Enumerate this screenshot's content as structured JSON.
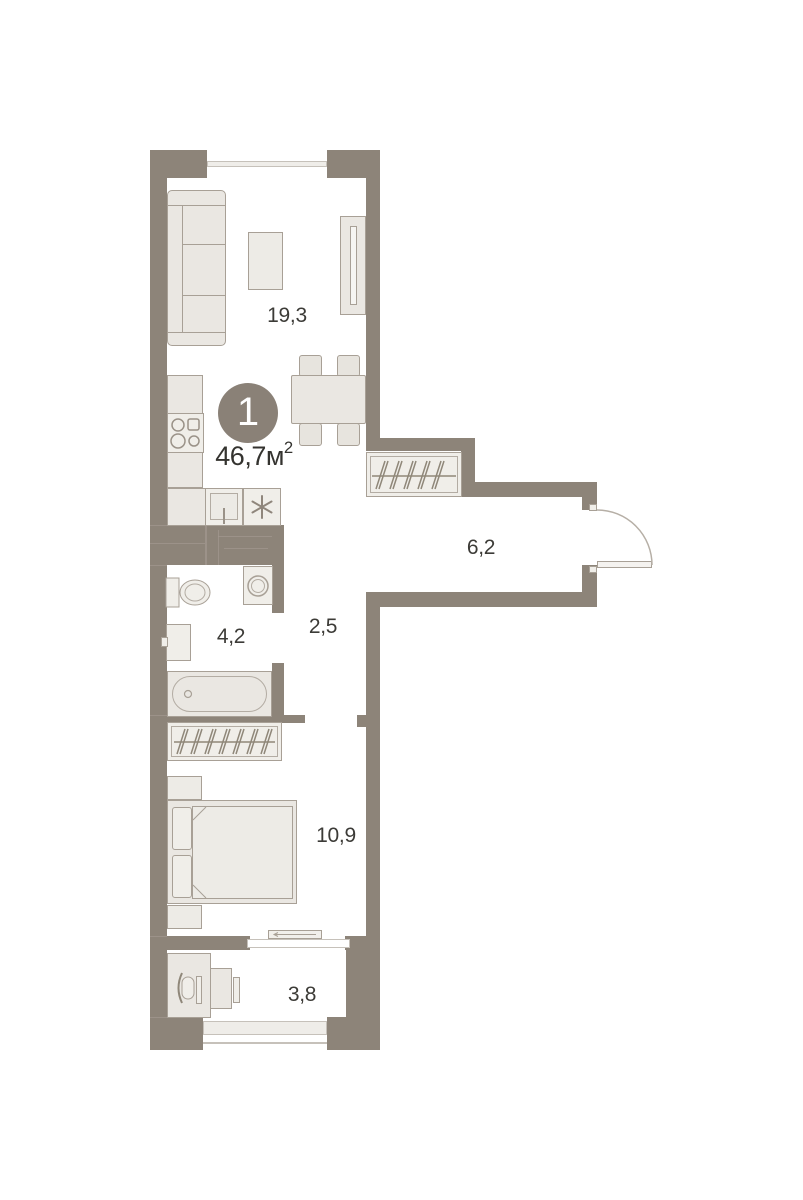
{
  "plan": {
    "badge": {
      "number": "1"
    },
    "total_area": {
      "value": "46,7",
      "unit": "м",
      "exponent": "2"
    },
    "rooms": [
      {
        "id": "living-kitchen",
        "area": "19,3"
      },
      {
        "id": "hallway",
        "area": "6,2"
      },
      {
        "id": "corridor",
        "area": "2,5"
      },
      {
        "id": "bathroom",
        "area": "4,2"
      },
      {
        "id": "bedroom",
        "area": "10,9"
      },
      {
        "id": "balcony",
        "area": "3,8"
      }
    ],
    "colors": {
      "wall": "#8d8479",
      "furniture_fill": "#eae7e2",
      "furniture_stroke": "#a8a096",
      "badge_fill": "#8a8177",
      "badge_text": "#ffffff",
      "label_text": "#3c3b37",
      "glazing": "#c6c1ba"
    }
  }
}
